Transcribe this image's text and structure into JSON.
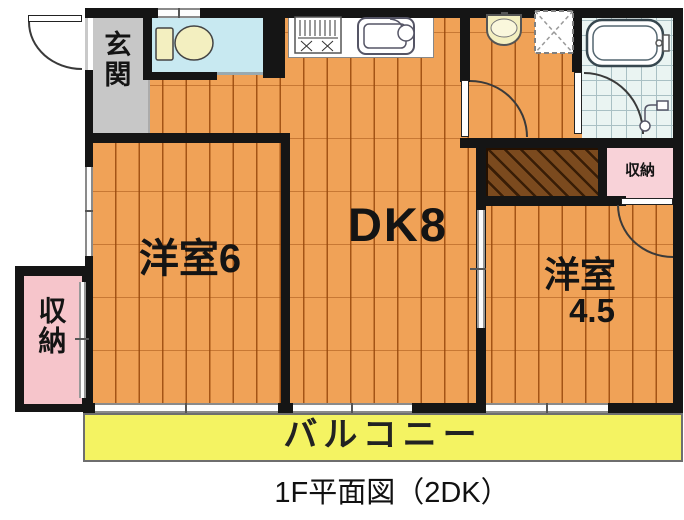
{
  "caption": {
    "text": "1F平面図（2DK）"
  },
  "labels": {
    "genkan": "玄関",
    "dk": "DK8",
    "west_room_6": "洋室6",
    "west_room_45_name": "洋室",
    "west_room_45_size": "4.5",
    "storage_left": "収納",
    "storage_right": "収納",
    "balcony": "バルコニー"
  },
  "colors": {
    "floor_wood": "#F0A257",
    "plank_line": "#96460A",
    "genkan_gray": "#C7C7C7",
    "toilet_floor": "#C8E9F1",
    "bath_tile": "#EAF4F2",
    "storage_pink_left": "#F6C5CB",
    "storage_pink_right": "#F8D2D8",
    "closet_brown": "#7B4A1E",
    "balcony_yellow": "#F4F362",
    "wall": "#151515",
    "fixture_cream": "#F3EFC0"
  },
  "icons": {
    "toilet": "toilet-icon",
    "stove": "stove-icon",
    "kitchen_sink": "sink-icon",
    "washbasin": "washbasin-icon",
    "washing_machine_pan": "washing-machine-icon",
    "bathtub": "bathtub-icon",
    "shower": "shower-icon",
    "door_arc": "door-arc",
    "window": "window-marker",
    "sliding_door": "sliding-door-marker"
  }
}
